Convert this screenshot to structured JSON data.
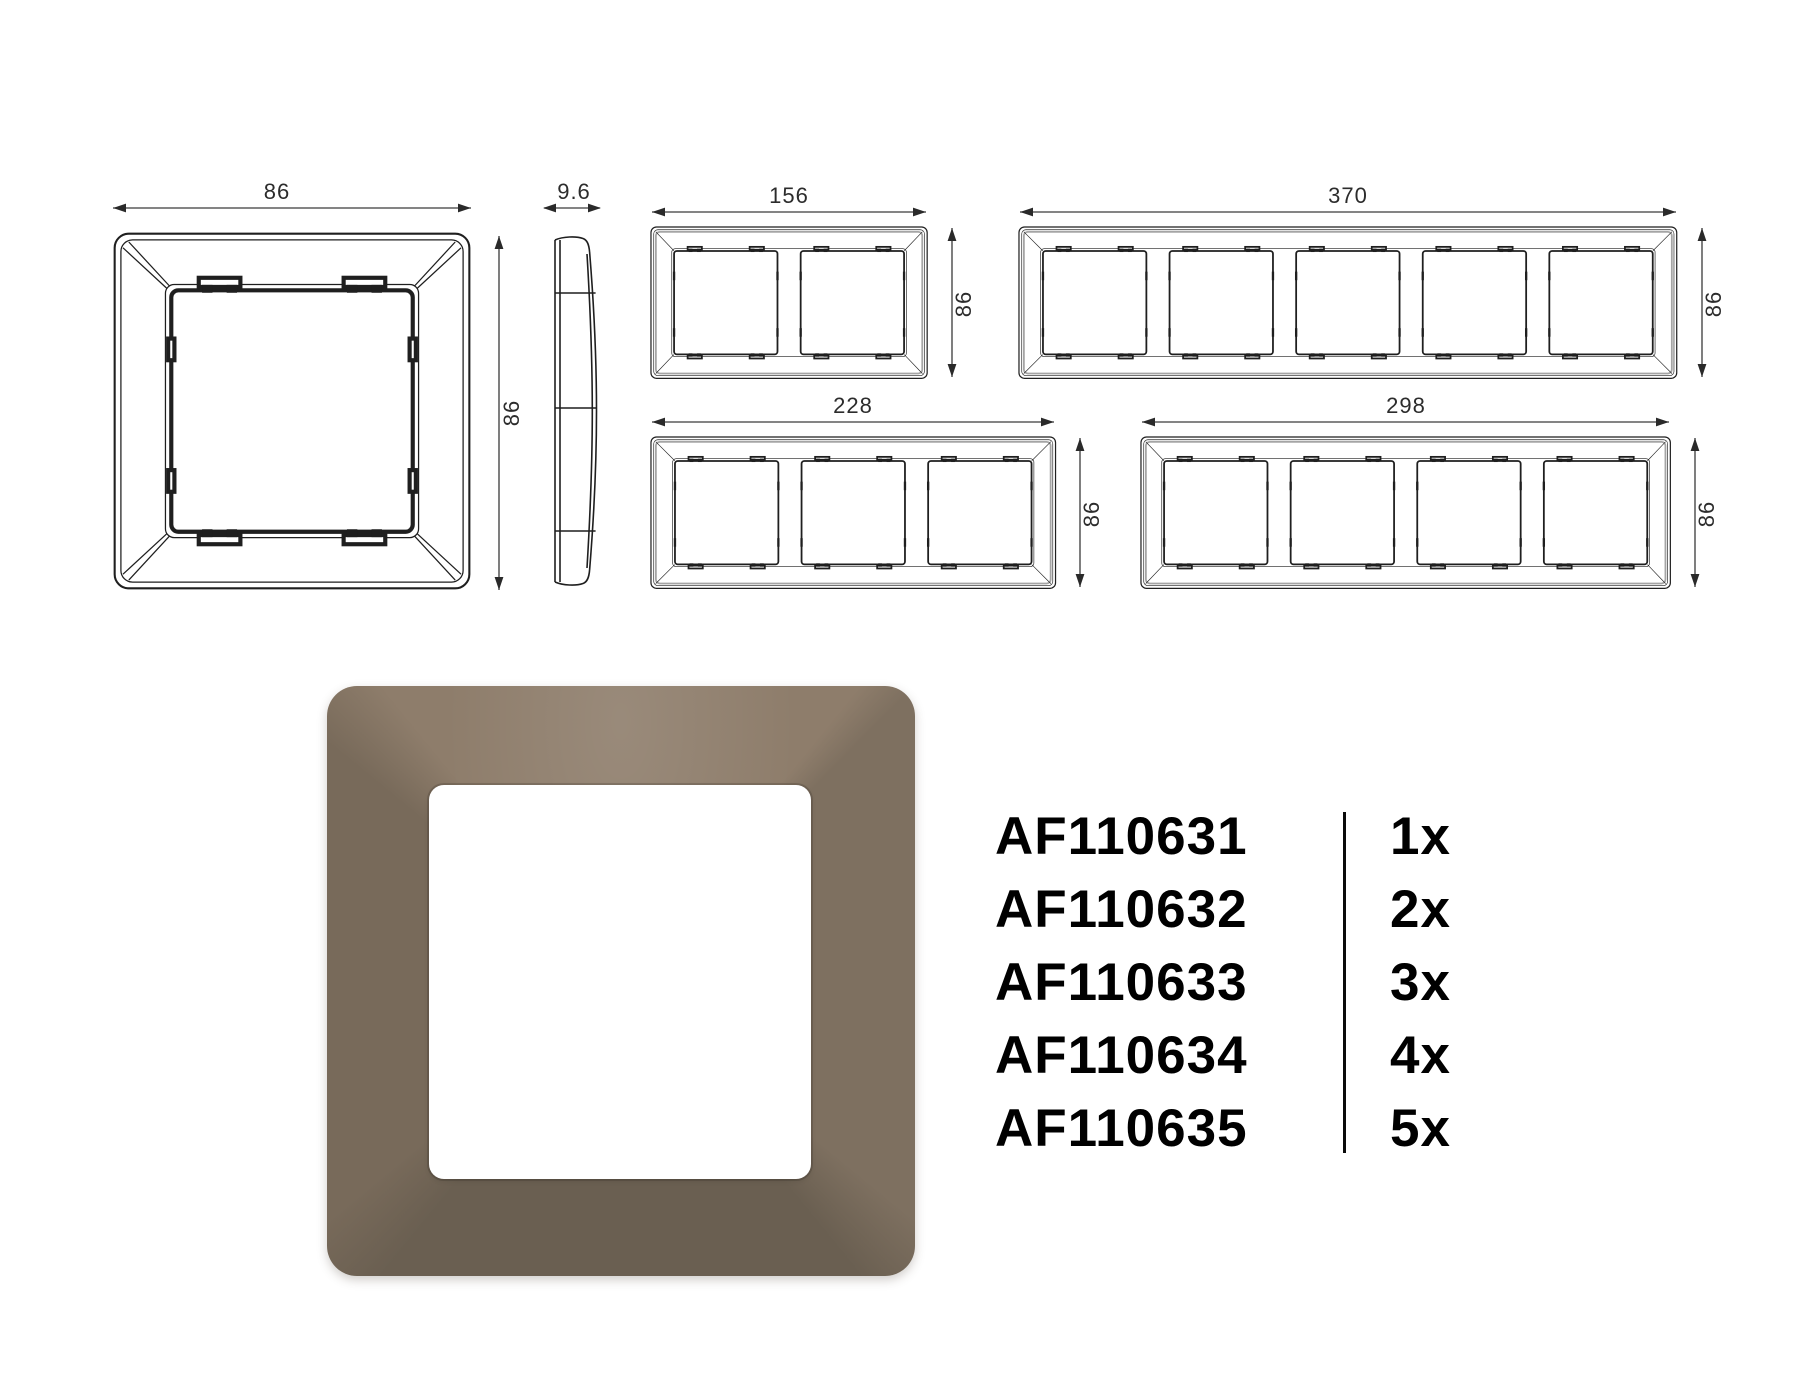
{
  "sheet": {
    "dims": {
      "frame_width": "86",
      "frame_height": "86",
      "profile_depth": "9.6",
      "two_gang_width": "156",
      "three_gang_width": "228",
      "four_gang_width": "298",
      "five_gang_width": "370"
    },
    "products": [
      {
        "code": "AF110631",
        "qty": "1x"
      },
      {
        "code": "AF110632",
        "qty": "2x"
      },
      {
        "code": "AF110633",
        "qty": "3x"
      },
      {
        "code": "AF110634",
        "qty": "4x"
      },
      {
        "code": "AF110635",
        "qty": "5x"
      }
    ],
    "colors": {
      "line": "#1f1f1f",
      "frame_top": "#8e7d6b",
      "frame_right": "#7e7060",
      "frame_bottom": "#6a5f51",
      "frame_left": "#786a5a",
      "opening": "#ffffff",
      "text": "#000000"
    }
  }
}
